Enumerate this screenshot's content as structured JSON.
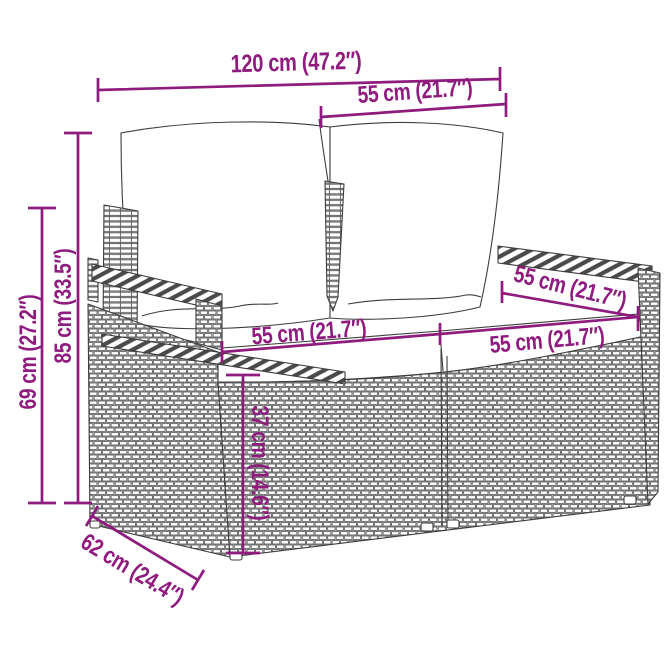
{
  "accent_color": "#8E1B7D",
  "illustration": {
    "icon": "rattan-loveseat-line-drawing"
  },
  "dimensions": {
    "total_width": {
      "label": "120 cm (47.2″)",
      "value_cm": 120,
      "value_in": 47.2
    },
    "seat_section_width": {
      "label": "55 cm (21.7″)",
      "value_cm": 55,
      "value_in": 21.7
    },
    "overall_height": {
      "label": "85 cm (33.5″)",
      "value_cm": 85,
      "value_in": 33.5
    },
    "arm_height": {
      "label": "69 cm (27.2″)",
      "value_cm": 69,
      "value_in": 27.2
    },
    "seat_width_left": {
      "label": "55 cm (21.7″)",
      "value_cm": 55,
      "value_in": 21.7
    },
    "seat_width_right": {
      "label": "55 cm (21.7″)",
      "value_cm": 55,
      "value_in": 21.7
    },
    "seat_depth": {
      "label": "55 cm (21.7″)",
      "value_cm": 55,
      "value_in": 21.7
    },
    "seat_height": {
      "label": "37 cm (14.6″)",
      "value_cm": 37,
      "value_in": 14.6
    },
    "total_depth": {
      "label": "62 cm (24.4″)",
      "value_cm": 62,
      "value_in": 24.4
    }
  }
}
